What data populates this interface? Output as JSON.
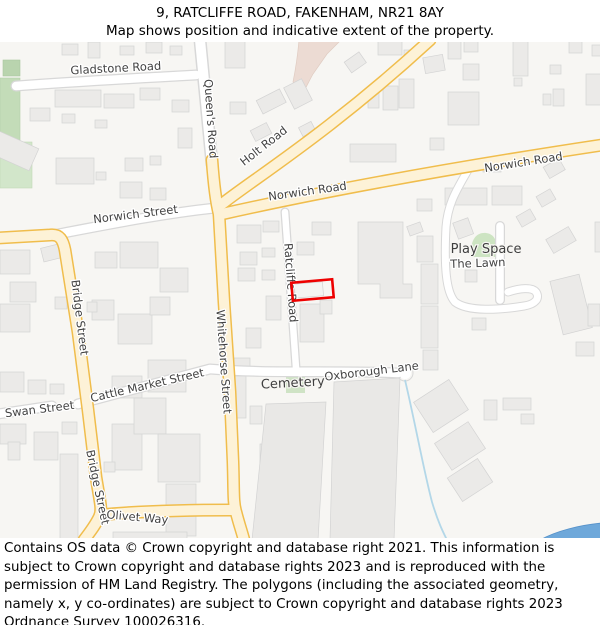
{
  "header": {
    "title": "9, RATCLIFFE ROAD, FAKENHAM, NR21 8AY",
    "subtitle": "Map shows position and indicative extent of the property."
  },
  "map": {
    "labels": {
      "gladstone_road": "Gladstone Road",
      "queens_road": "Queen's Road",
      "holt_road": "Holt Road",
      "norwich_road_west": "Norwich Road",
      "norwich_road_east": "Norwich Road",
      "norwich_street": "Norwich Street",
      "bridge_street_upper": "Bridge Street",
      "bridge_street_lower": "Bridge Street",
      "whitehorse_street": "Whitehorse Street",
      "ratcliffe_road": "Ratcliffe Road",
      "swan_street": "Swan Street",
      "cattle_market_street": "Cattle Market Street",
      "oxborough_lane": "Oxborough Lane",
      "olivet_way": "Olivet Way",
      "cemetery": "Cemetery",
      "play_space": "Play Space",
      "the_lawn": "The Lawn"
    },
    "colors": {
      "background": "#f7f6f3",
      "road_primary_fill": "#fdf2d7",
      "road_primary_casing": "#f0bd4c",
      "road_minor_fill": "#ffffff",
      "road_minor_casing": "#d8d8d8",
      "building_fill": "#ebeae8",
      "building_stroke": "#d3d3d3",
      "green_area": "#d2e6ca",
      "green_area_dark": "#c3dcb8",
      "retail_area": "#ecdbd3",
      "stream": "#b3d7e8",
      "water": "#6ea8da",
      "property_outline": "#ee0000",
      "label_color": "#434343"
    },
    "marker": {
      "name": "property-extent-9-ratcliffe-road"
    }
  },
  "footer": {
    "text": "Contains OS data © Crown copyright and database right 2021. This information is subject to Crown copyright and database rights 2023 and is reproduced with the permission of HM Land Registry. The polygons (including the associated geometry, namely x, y co-ordinates) are subject to Crown copyright and database rights 2023 Ordnance Survey 100026316."
  }
}
